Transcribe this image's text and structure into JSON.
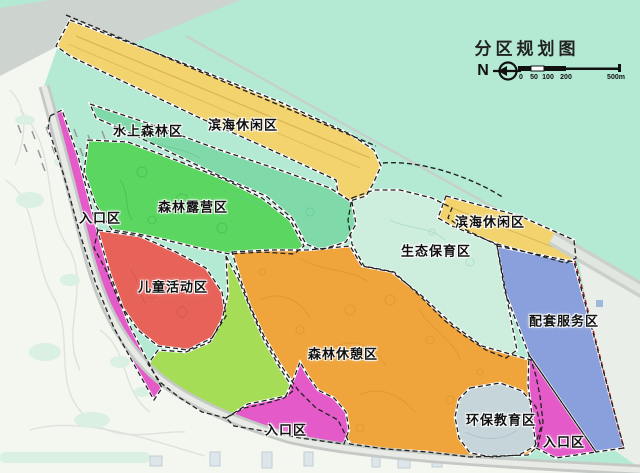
{
  "title": "分区规划图",
  "compass": {
    "north_label": "N"
  },
  "scale_bar": {
    "tick_labels": [
      "0",
      "50",
      "100",
      "200"
    ],
    "end_label": "500m"
  },
  "zones": {
    "coastal_leisure_north": {
      "label": "滨海休闲区",
      "color": "#f2d36d"
    },
    "coastal_leisure_east": {
      "label": "滨海休闲区",
      "color": "#f2d36d"
    },
    "water_forest": {
      "label": "水上森林区",
      "color": "#7fd9a8"
    },
    "forest_camping": {
      "label": "森林露营区",
      "color": "#5bd661"
    },
    "entrance_west": {
      "label": "入口区",
      "color": "#e35ac8"
    },
    "children_activity": {
      "label": "儿童活动区",
      "color": "#e7635a"
    },
    "eco_conservation": {
      "label": "生态保育区",
      "color": "#cdeedd"
    },
    "forest_recreation": {
      "label": "森林休憩区",
      "color": "#efa43c"
    },
    "support_services": {
      "label": "配套服务区",
      "color": "#8aa0dc"
    },
    "entrance_south": {
      "label": "入口区",
      "color": "#e35ac8"
    },
    "eco_education": {
      "label": "环保教育区",
      "color": "#c5d5da"
    },
    "entrance_southeast": {
      "label": "入口区",
      "color": "#e35ac8"
    },
    "unlabeled_green": {
      "color": "#a6dd57"
    }
  },
  "base": {
    "sea": "#b4e9d4",
    "land_west": "#f4f6f0",
    "land_east": "#e9efe8",
    "shore_band": "#cdd3cf",
    "road": "#c4c9c5",
    "boundary_dash": "#222222",
    "boundary_red_dash": "#9b2d2d"
  }
}
